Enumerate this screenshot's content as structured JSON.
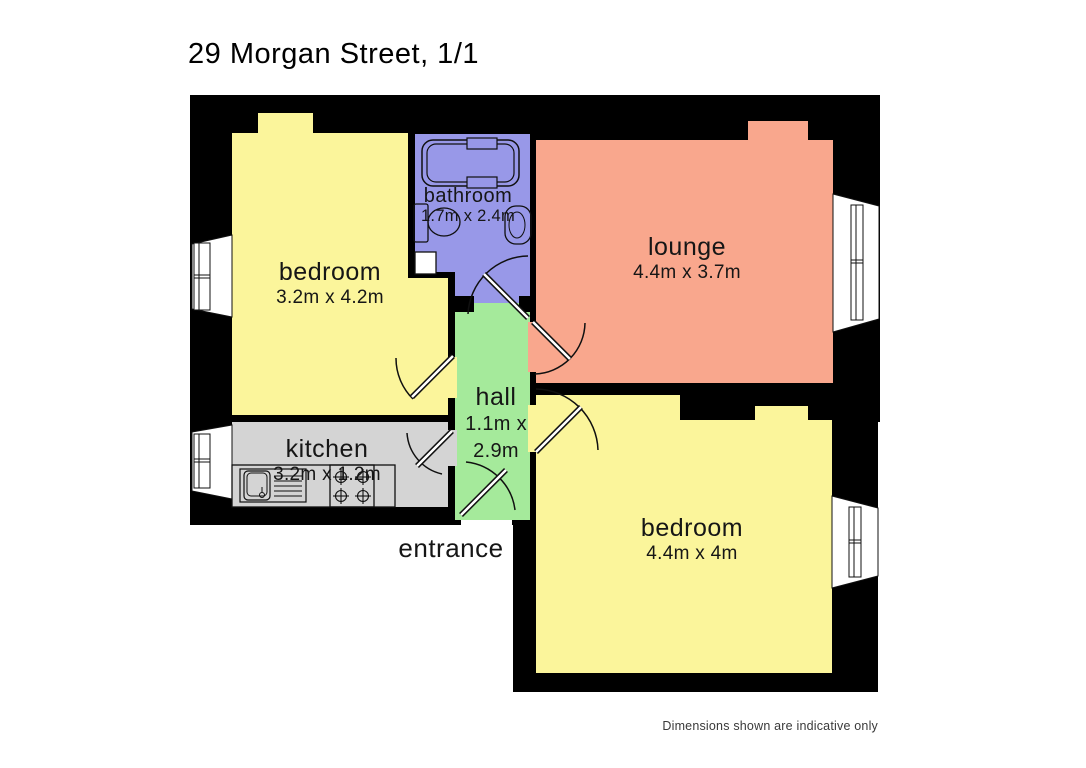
{
  "page": {
    "title": "29 Morgan Street, 1/1",
    "entrance_label": "entrance",
    "disclaimer": "Dimensions shown are indicative only"
  },
  "colors": {
    "walls": "#000000",
    "background": "#ffffff",
    "window_glass": "#ffffff"
  },
  "rooms": [
    {
      "id": "bedroom-front",
      "name": "bedroom",
      "dimensions": "3.2m x 4.2m",
      "color": "#FBF59B"
    },
    {
      "id": "bathroom",
      "name": "bathroom",
      "dimensions": "1.7m x 2.4m",
      "color": "#9898E8"
    },
    {
      "id": "lounge",
      "name": "lounge",
      "dimensions": "4.4m x 3.7m",
      "color": "#F9A78D"
    },
    {
      "id": "hall",
      "name": "hall",
      "dimensions_line1": "1.1m x",
      "dimensions_line2": "2.9m",
      "color": "#A5EA9B"
    },
    {
      "id": "kitchen",
      "name": "kitchen",
      "dimensions": "3.2m x 1.2m",
      "color": "#D4D4D4"
    },
    {
      "id": "bedroom-rear",
      "name": "bedroom",
      "dimensions": "4.4m x 4m",
      "color": "#FBF59B"
    }
  ],
  "fixtures": [
    "bathtub",
    "toilet",
    "basin",
    "shower-tray",
    "kitchen-sink",
    "drainer",
    "cooker-hob"
  ]
}
